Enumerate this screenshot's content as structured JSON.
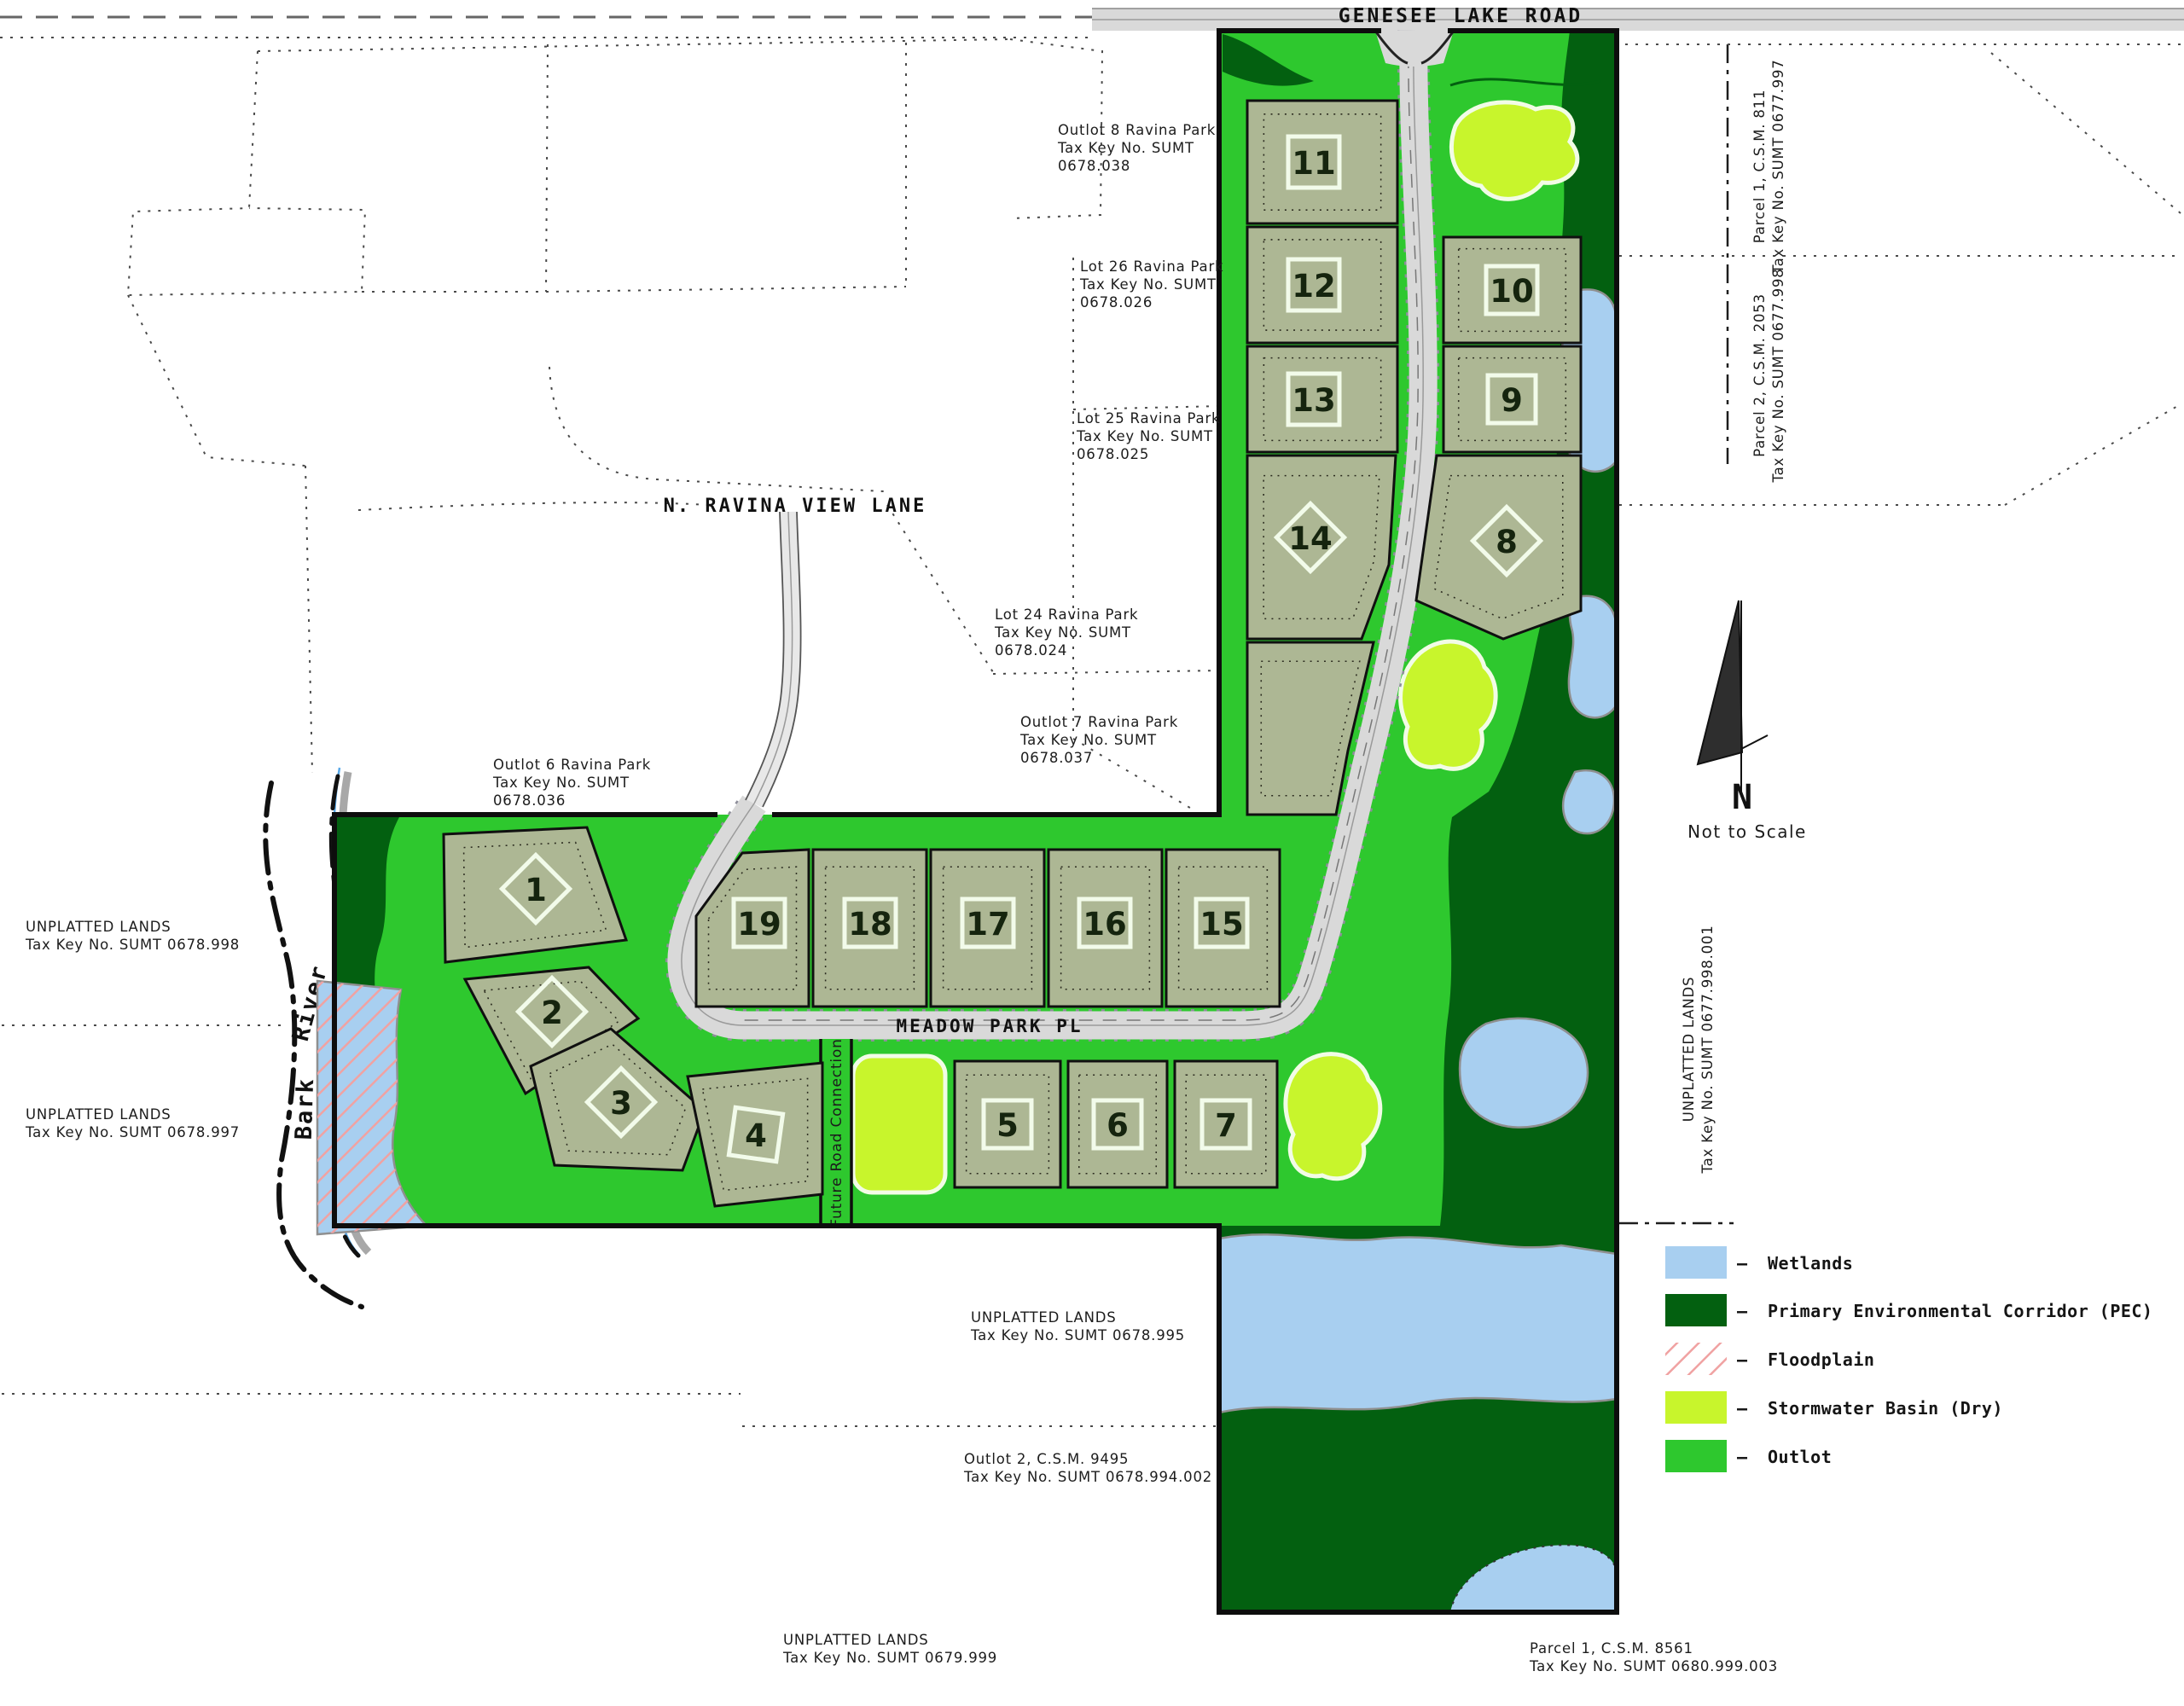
{
  "map": {
    "roads": {
      "genesee_lake_road": "GENESEE LAKE ROAD",
      "n_ravina_view_lane": "N. RAVINA VIEW LANE",
      "meadow_park_pl": "MEADOW PARK PL",
      "future_road_connection": "Future Road Connection"
    },
    "river": {
      "word_upper": "River",
      "word_lower": "Bark"
    },
    "lots": [
      "1",
      "2",
      "3",
      "4",
      "5",
      "6",
      "7",
      "8",
      "9",
      "10",
      "11",
      "12",
      "13",
      "14",
      "15",
      "16",
      "17",
      "18",
      "19"
    ],
    "annotations": [
      {
        "id": "outlot-8",
        "lines": [
          "Outlot 8 Ravina Park",
          "Tax Key No. SUMT",
          "0678.038"
        ]
      },
      {
        "id": "lot-26",
        "lines": [
          "Lot 26 Ravina Park",
          "Tax Key No. SUMT",
          "0678.026"
        ]
      },
      {
        "id": "lot-25",
        "lines": [
          "Lot 25 Ravina Park",
          "Tax Key No. SUMT",
          "0678.025"
        ]
      },
      {
        "id": "lot-24",
        "lines": [
          "Lot 24 Ravina Park",
          "Tax Key No. SUMT",
          "0678.024"
        ]
      },
      {
        "id": "outlot-7",
        "lines": [
          "Outlot 7 Ravina Park",
          "Tax Key No. SUMT",
          "0678.037"
        ]
      },
      {
        "id": "outlot-6",
        "lines": [
          "Outlot 6 Ravina Park",
          "Tax Key No. SUMT",
          "0678.036"
        ]
      },
      {
        "id": "unplatted-0678-998",
        "lines": [
          "UNPLATTED LANDS",
          "Tax Key No. SUMT 0678.998"
        ]
      },
      {
        "id": "unplatted-0678-997",
        "lines": [
          "UNPLATTED LANDS",
          "Tax Key No. SUMT 0678.997"
        ]
      },
      {
        "id": "unplatted-0678-995",
        "lines": [
          "UNPLATTED LANDS",
          "Tax Key No. SUMT 0678.995"
        ]
      },
      {
        "id": "outlot-2-csm-9495",
        "lines": [
          "Outlot 2, C.S.M. 9495",
          "Tax Key No. SUMT 0678.994.002"
        ]
      },
      {
        "id": "unplatted-0679-999",
        "lines": [
          "UNPLATTED LANDS",
          "Tax Key No. SUMT 0679.999"
        ]
      },
      {
        "id": "parcel-1-csm-8561",
        "lines": [
          "Parcel 1, C.S.M. 8561",
          "Tax Key No. SUMT 0680.999.003"
        ]
      },
      {
        "id": "parcel-1-csm-811",
        "lines": [
          "Parcel 1, C.S.M. 811",
          "Tax Key No. SUMT 0677.997"
        ]
      },
      {
        "id": "parcel-2-csm-2053",
        "lines": [
          "Parcel 2, C.S.M. 2053",
          "Tax Key No. SUMT 0677.998"
        ]
      },
      {
        "id": "unplatted-0677-998-001",
        "lines": [
          "UNPLATTED LANDS",
          "Tax Key No. SUMT 0677.998.001"
        ]
      }
    ],
    "north_arrow": {
      "label": "N",
      "note": "Not to Scale"
    },
    "legend": {
      "separator": "–",
      "items": [
        {
          "label": "Wetlands",
          "color": "#a8cff0",
          "swatch": "fill"
        },
        {
          "label": "Primary Environmental Corridor (PEC)",
          "color": "#036010",
          "swatch": "fill"
        },
        {
          "label": "Floodplain",
          "color": "#f0a2a2",
          "swatch": "hatch"
        },
        {
          "label": "Stormwater Basin (Dry)",
          "color": "#c8f52c",
          "swatch": "fill"
        },
        {
          "label": "Outlot",
          "color": "#2ec82e",
          "swatch": "fill"
        }
      ]
    },
    "colors": {
      "outlot": "#2ec82e",
      "pec": "#036010",
      "wetland": "#a8cff0",
      "basin": "#c8f52c",
      "lot_fill": "#adb794",
      "road": "#d9d9d9",
      "floodplain_hatch": "#f0a2a2",
      "boundary": "#0d0d0d"
    }
  }
}
